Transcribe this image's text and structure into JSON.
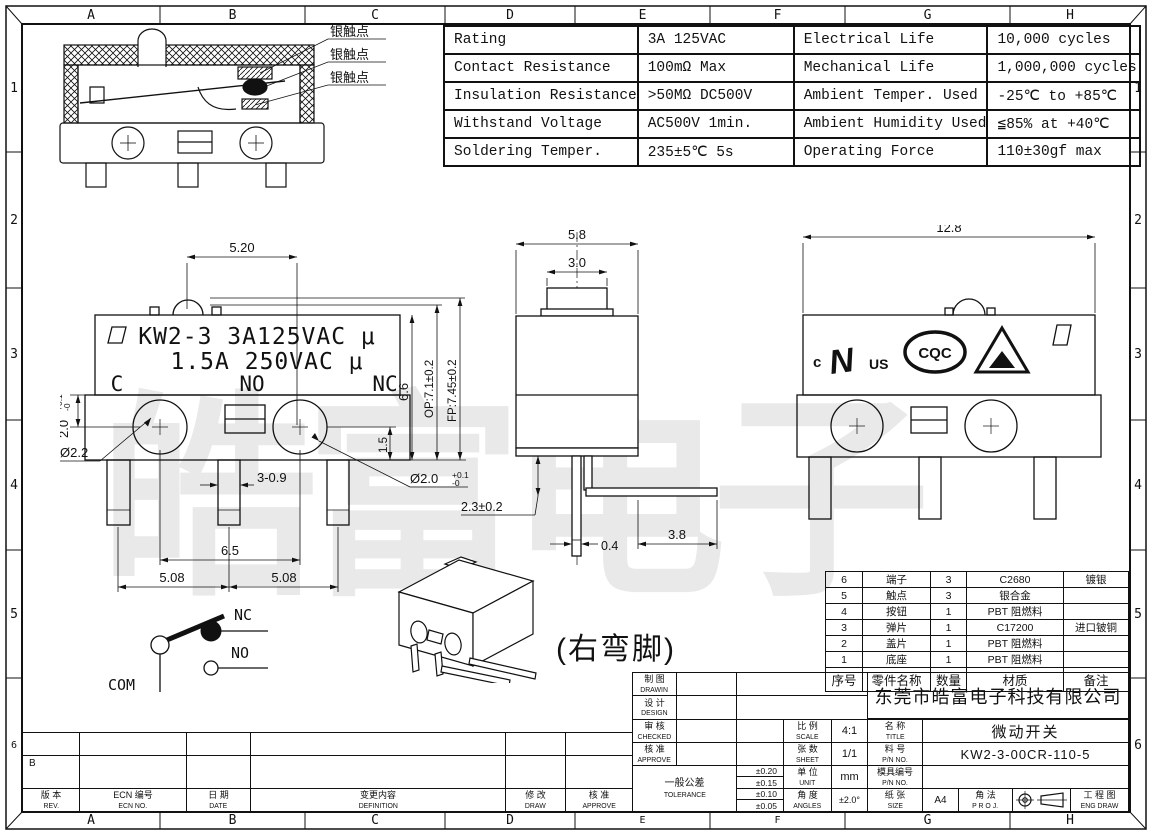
{
  "frame": {
    "columns": [
      "A",
      "B",
      "C",
      "D",
      "E",
      "F",
      "G",
      "H"
    ],
    "rows": [
      "1",
      "2",
      "3",
      "4",
      "5",
      "6"
    ]
  },
  "spec_table": {
    "rows": [
      {
        "param1": "Rating",
        "value1": "3A  125VAC",
        "param2": "Electrical Life",
        "value2": "10,000 cycles"
      },
      {
        "param1": "Contact Resistance",
        "value1": "100mΩ  Max",
        "param2": "Mechanical Life",
        "value2": "1,000,000 cycles"
      },
      {
        "param1": "Insulation Resistance",
        "value1": ">50MΩ  DC500V",
        "param2": "Ambient Temper. Used",
        "value2": "-25℃ to +85℃"
      },
      {
        "param1": "Withstand Voltage",
        "value1": "AC500V  1min.",
        "param2": "Ambient Humidity Used",
        "value2": "≦85% at +40℃"
      },
      {
        "param1": "Soldering Temper.",
        "value1": "235±5℃ 5s",
        "param2": "Operating Force",
        "value2": "110±30gf max"
      }
    ]
  },
  "section_view": {
    "contact_labels": [
      "银触点",
      "银触点",
      "银触点"
    ]
  },
  "front_view": {
    "marking_line1": "KW2-3 3A125VAC μ",
    "marking_line2": "1.5A 250VAC μ",
    "terminal_c": "C",
    "terminal_no": "NO",
    "terminal_nc": "NC",
    "dim_top": "5.20",
    "dim_pitch": "6.5",
    "dim_pin_left": "5.08",
    "dim_pin_right": "5.08",
    "dim_pin_width": "3-0.9",
    "dim_hole_left": "Ø2.2",
    "dim_left_main": "2.0",
    "dim_left_tol_up": "+0.1",
    "dim_left_tol_dn": "-0",
    "dim_hole_right": "Ø2.0",
    "dim_right_tol_up": "+0.1",
    "dim_right_tol_dn": "-0",
    "dim_1_5": "1.5",
    "dim_6_6": "6.6",
    "dim_op": "OP:7.1±0.2",
    "dim_fp": "FP:7.45±0.2"
  },
  "side_view": {
    "dim_width": "5.8",
    "dim_button": "3.0",
    "dim_pin_len": "2.3±0.2",
    "dim_pin_thk": "0.4",
    "dim_bent": "3.8"
  },
  "right_view": {
    "dim_width": "12.8",
    "ul_c": "c",
    "ul_mark": "N",
    "ul_us": "US",
    "cqc": "CQC"
  },
  "circuit": {
    "com": "COM",
    "nc": "NC",
    "no": "NO"
  },
  "iso_note": "(右弯脚)",
  "watermark": "皓富电子",
  "bom_table": {
    "headers": [
      "序号",
      "零件名称",
      "数量",
      "材质",
      "备注"
    ],
    "rows": [
      [
        "6",
        "端子",
        "3",
        "C2680",
        "镀银"
      ],
      [
        "5",
        "触点",
        "3",
        "银合金",
        ""
      ],
      [
        "4",
        "按钮",
        "1",
        "PBT  阻燃料",
        ""
      ],
      [
        "3",
        "弹片",
        "1",
        "C17200",
        "进口铍铜"
      ],
      [
        "2",
        "盖片",
        "1",
        "PBT  阻燃料",
        ""
      ],
      [
        "1",
        "底座",
        "1",
        "PBT  阻燃料",
        ""
      ]
    ]
  },
  "title_block": {
    "company": "东莞市皓富电子科技有限公司",
    "drawn_cn": "制 图",
    "drawn_en": "DRAWIN",
    "design_cn": "设 计",
    "design_en": "DESIGN",
    "checked_cn": "审 核",
    "checked_en": "CHECKED",
    "approve_cn": "核 准",
    "approve_en": "APPROVE",
    "tol_cn": "一般公差",
    "tol_en": "TOLERANCE",
    "tol_values": [
      "±0.20",
      "±0.15",
      "±0.10",
      "±0.05"
    ],
    "scale_cn": "比 例",
    "scale_en": "SCALE",
    "scale_value": "4:1",
    "sheet_cn": "张 数",
    "sheet_en": "SHEET",
    "sheet_value": "1/1",
    "unit_cn": "单 位",
    "unit_en": "UNIT",
    "unit_value": "mm",
    "angles_cn": "角 度",
    "angles_en": "ANGLES",
    "angles_value": "±2.0°",
    "name_cn": "名 称",
    "name_en": "TITLE",
    "name_value": "微动开关",
    "pn_cn": "料 号",
    "pn_en": "P/N NO.",
    "pn_value": "KW2-3-00CR-110-5",
    "mold_cn": "模具编号",
    "mold_en": "P/N NO.",
    "mold_value": "",
    "paper_cn": "纸 张",
    "paper_en": "SIZE",
    "paper_value": "A4",
    "proj_cn": "角 法",
    "proj_en": "P R O J.",
    "eng_cn": "工 程 图",
    "eng_en": "ENG DRAW"
  },
  "revision": {
    "entry": "B",
    "rev_cn": "版 本",
    "rev_en": "REV.",
    "ecn_cn": "ECN 编号",
    "ecn_en": "ECN NO.",
    "date_cn": "日 期",
    "date_en": "DATE",
    "def_cn": "变更内容",
    "def_en": "DEFINITION",
    "draw_cn": "修 改",
    "draw_en": "DRAW",
    "approve_cn": "核 准",
    "approve_en": "APPROVE"
  }
}
